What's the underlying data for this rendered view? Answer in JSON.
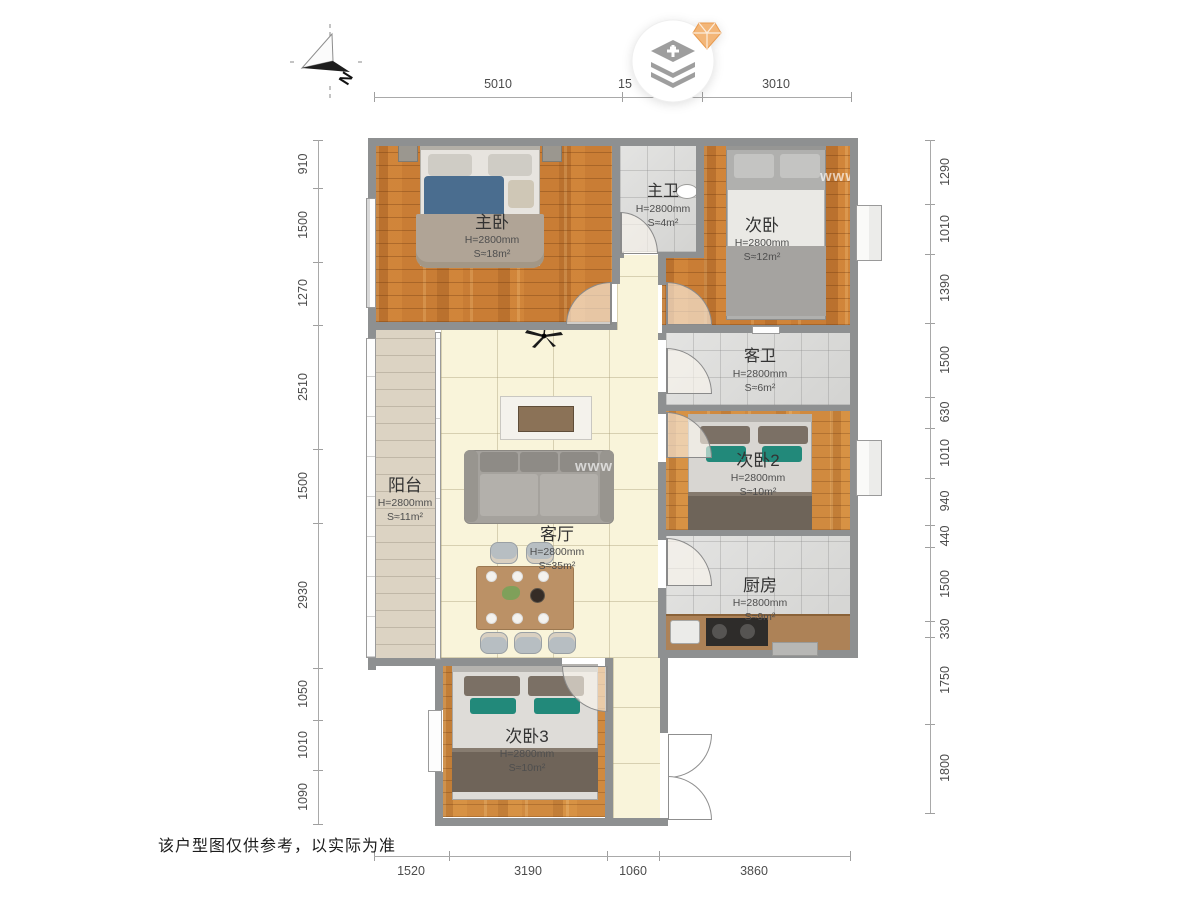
{
  "compass": {
    "label": "N",
    "icon": "north-arrow-icon"
  },
  "branding": {
    "icon": "layer-stack-plus-logo",
    "gem_icon": "orange-gem-icon",
    "accent_color": "#f3b678",
    "icon_color": "#9e9e9e"
  },
  "dimensions": {
    "top": [
      "5010",
      "15",
      "3010"
    ],
    "bottom": [
      "1520",
      "3190",
      "1060",
      "3860"
    ],
    "left": [
      "910",
      "1500",
      "1270",
      "2510",
      "1500",
      "2930",
      "1050",
      "1010",
      "1090"
    ],
    "right": [
      "1290",
      "1010",
      "1390",
      "1500",
      "630",
      "1010",
      "940",
      "440",
      "1500",
      "330",
      "1750",
      "1800"
    ]
  },
  "rooms": {
    "master_bedroom": {
      "name": "主卧",
      "height": "H=2800mm",
      "area": "S≈18m²"
    },
    "master_bath": {
      "name": "主卫",
      "height": "H=2800mm",
      "area": "S≈4m²"
    },
    "bedroom2": {
      "name": "次卧",
      "height": "H=2800mm",
      "area": "S≈12m²"
    },
    "guest_bath": {
      "name": "客卫",
      "height": "H=2800mm",
      "area": "S≈6m²"
    },
    "bedroom3": {
      "name": "次卧2",
      "height": "H=2800mm",
      "area": "S≈10m²"
    },
    "kitchen": {
      "name": "厨房",
      "height": "H=2800mm",
      "area": "S≈9m²"
    },
    "balcony": {
      "name": "阳台",
      "height": "H=2800mm",
      "area": "S≈11m²"
    },
    "living": {
      "name": "客厅",
      "height": "H=2800mm",
      "area": "S≈35m²"
    },
    "bedroom4": {
      "name": "次卧3",
      "height": "H=2800mm",
      "area": "S≈10m²"
    }
  },
  "footer": {
    "disclaimer": "该户型图仅供参考，以实际为准"
  },
  "watermark": {
    "text": "www"
  }
}
